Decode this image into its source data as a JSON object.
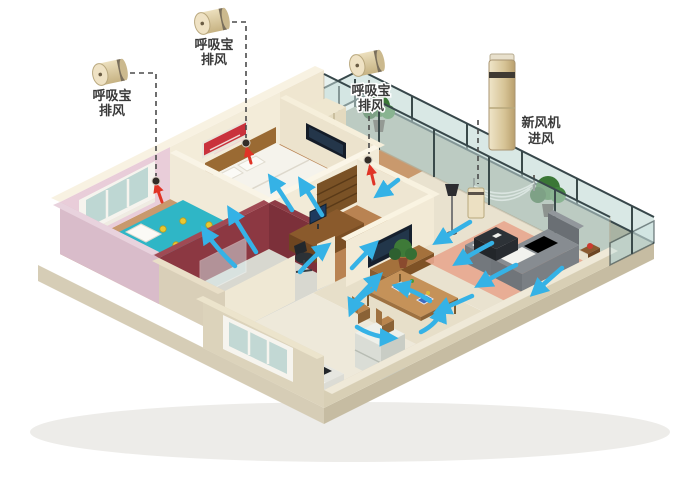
{
  "annotations": {
    "exhaust_units": [
      {
        "name": "breathing-exhaust-unit-1",
        "line1": "呼吸宝",
        "line2": "排风"
      },
      {
        "name": "breathing-exhaust-unit-2",
        "line1": "呼吸宝",
        "line2": "排风"
      },
      {
        "name": "breathing-exhaust-unit-3",
        "line1": "呼吸宝",
        "line2": "排风"
      }
    ],
    "fresh_air_unit": {
      "name": "fresh-air-machine",
      "line1": "新风机",
      "line2": "进风"
    }
  },
  "icons": {
    "exhaust_device": "small-gold-cylinder-fan-icon",
    "fresh_air_device": "tall-gold-tower-unit-icon",
    "wall_vent": "dark-round-vent-icon",
    "airflow": "blue-curved-arrow",
    "exhaust_flow": "red-arrow"
  },
  "colors": {
    "background": "#ffffff",
    "airflow": "#35b2e6",
    "exhaust_flow": "#e03427",
    "leader_line": "#4a4a4a",
    "label_text": "#3a3a3a",
    "device_gold": "#d9c79c",
    "wall_pink": "#e9cdd9",
    "wall_cream": "#f2ebd8",
    "bathroom_maroon": "#8c3842",
    "kids_quilt_teal": "#2fb6c6",
    "living_rug_salmon": "#e8a78e"
  }
}
